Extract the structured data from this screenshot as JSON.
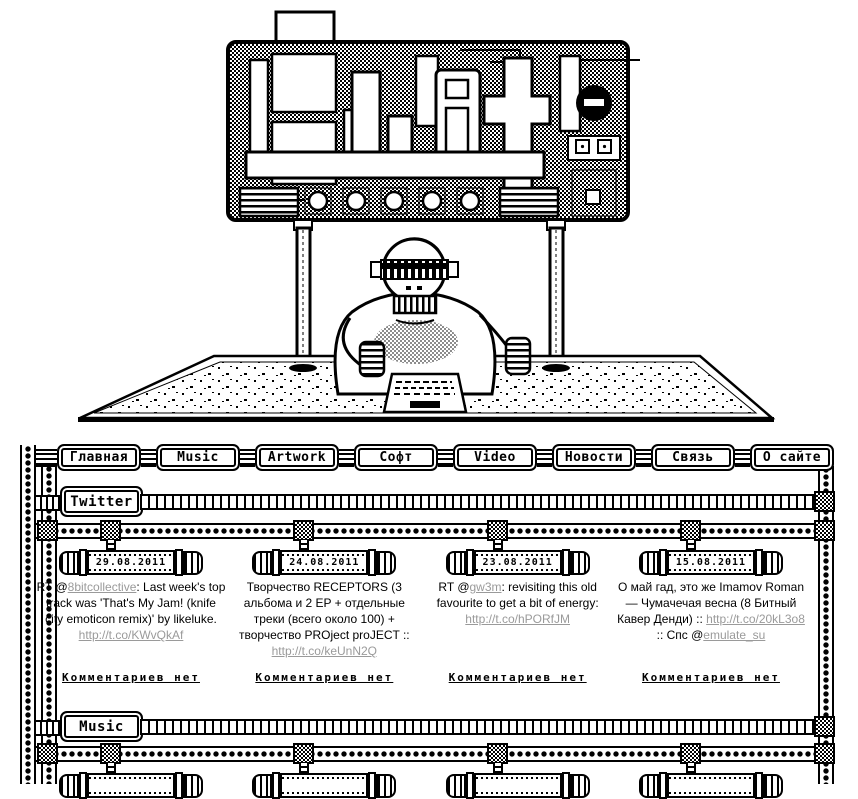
{
  "colors": {
    "ink": "#000000",
    "paper": "#ffffff",
    "link": "#9a9a9a"
  },
  "header_art": {
    "name": "pixel-art-billboard-robot",
    "alt": "monochrome pixel art: billboard sign with pixel glyph logo on two poles, robot seated at a table on a dithered platform"
  },
  "nav": {
    "items": [
      {
        "id": "glavnaya",
        "label": "Главная"
      },
      {
        "id": "music",
        "label": "Music"
      },
      {
        "id": "artwork",
        "label": "Artwork"
      },
      {
        "id": "soft",
        "label": "Софт"
      },
      {
        "id": "video",
        "label": "Video"
      },
      {
        "id": "novosti",
        "label": "Новости"
      },
      {
        "id": "svyaz",
        "label": "Связь"
      },
      {
        "id": "osayte",
        "label": "О сайте"
      }
    ]
  },
  "twitter_section": {
    "label": "Twitter",
    "posts": [
      {
        "date": "29.08.2011",
        "segments": [
          {
            "text": "RT @"
          },
          {
            "text": "8bitcollective",
            "link": true
          },
          {
            "text": ": Last week's top track was 'That's My Jam! (knife city emoticon remix)' by likeluke. "
          },
          {
            "text": "http://t.co/KWvQkAf",
            "link": true
          }
        ],
        "comments": "Комментариев нет"
      },
      {
        "date": "24.08.2011",
        "segments": [
          {
            "text": "Творчество RECEPTORS (3 альбома и 2 EP + отдельные треки (всего около 100) + творчество PROject proJECT :: "
          },
          {
            "text": "http://t.co/keUnN2Q",
            "link": true
          }
        ],
        "comments": "Комментариев нет"
      },
      {
        "date": "23.08.2011",
        "segments": [
          {
            "text": "RT @"
          },
          {
            "text": "gw3m",
            "link": true
          },
          {
            "text": ": revisiting this old favourite to get a bit of energy: "
          },
          {
            "text": "http://t.co/hPORfJM",
            "link": true
          }
        ],
        "comments": "Комментариев нет"
      },
      {
        "date": "15.08.2011",
        "segments": [
          {
            "text": "О май гад, это же Imamov Roman — Чумачечая весна (8 Битный Кавер Денди) :: "
          },
          {
            "text": "http://t.co/20kL3o8",
            "link": true
          },
          {
            "text": " :: Спс @"
          },
          {
            "text": "emulate_su",
            "link": true
          }
        ],
        "comments": "Комментариев нет"
      }
    ]
  },
  "music_section": {
    "label": "Music",
    "partial_posts": 4
  }
}
